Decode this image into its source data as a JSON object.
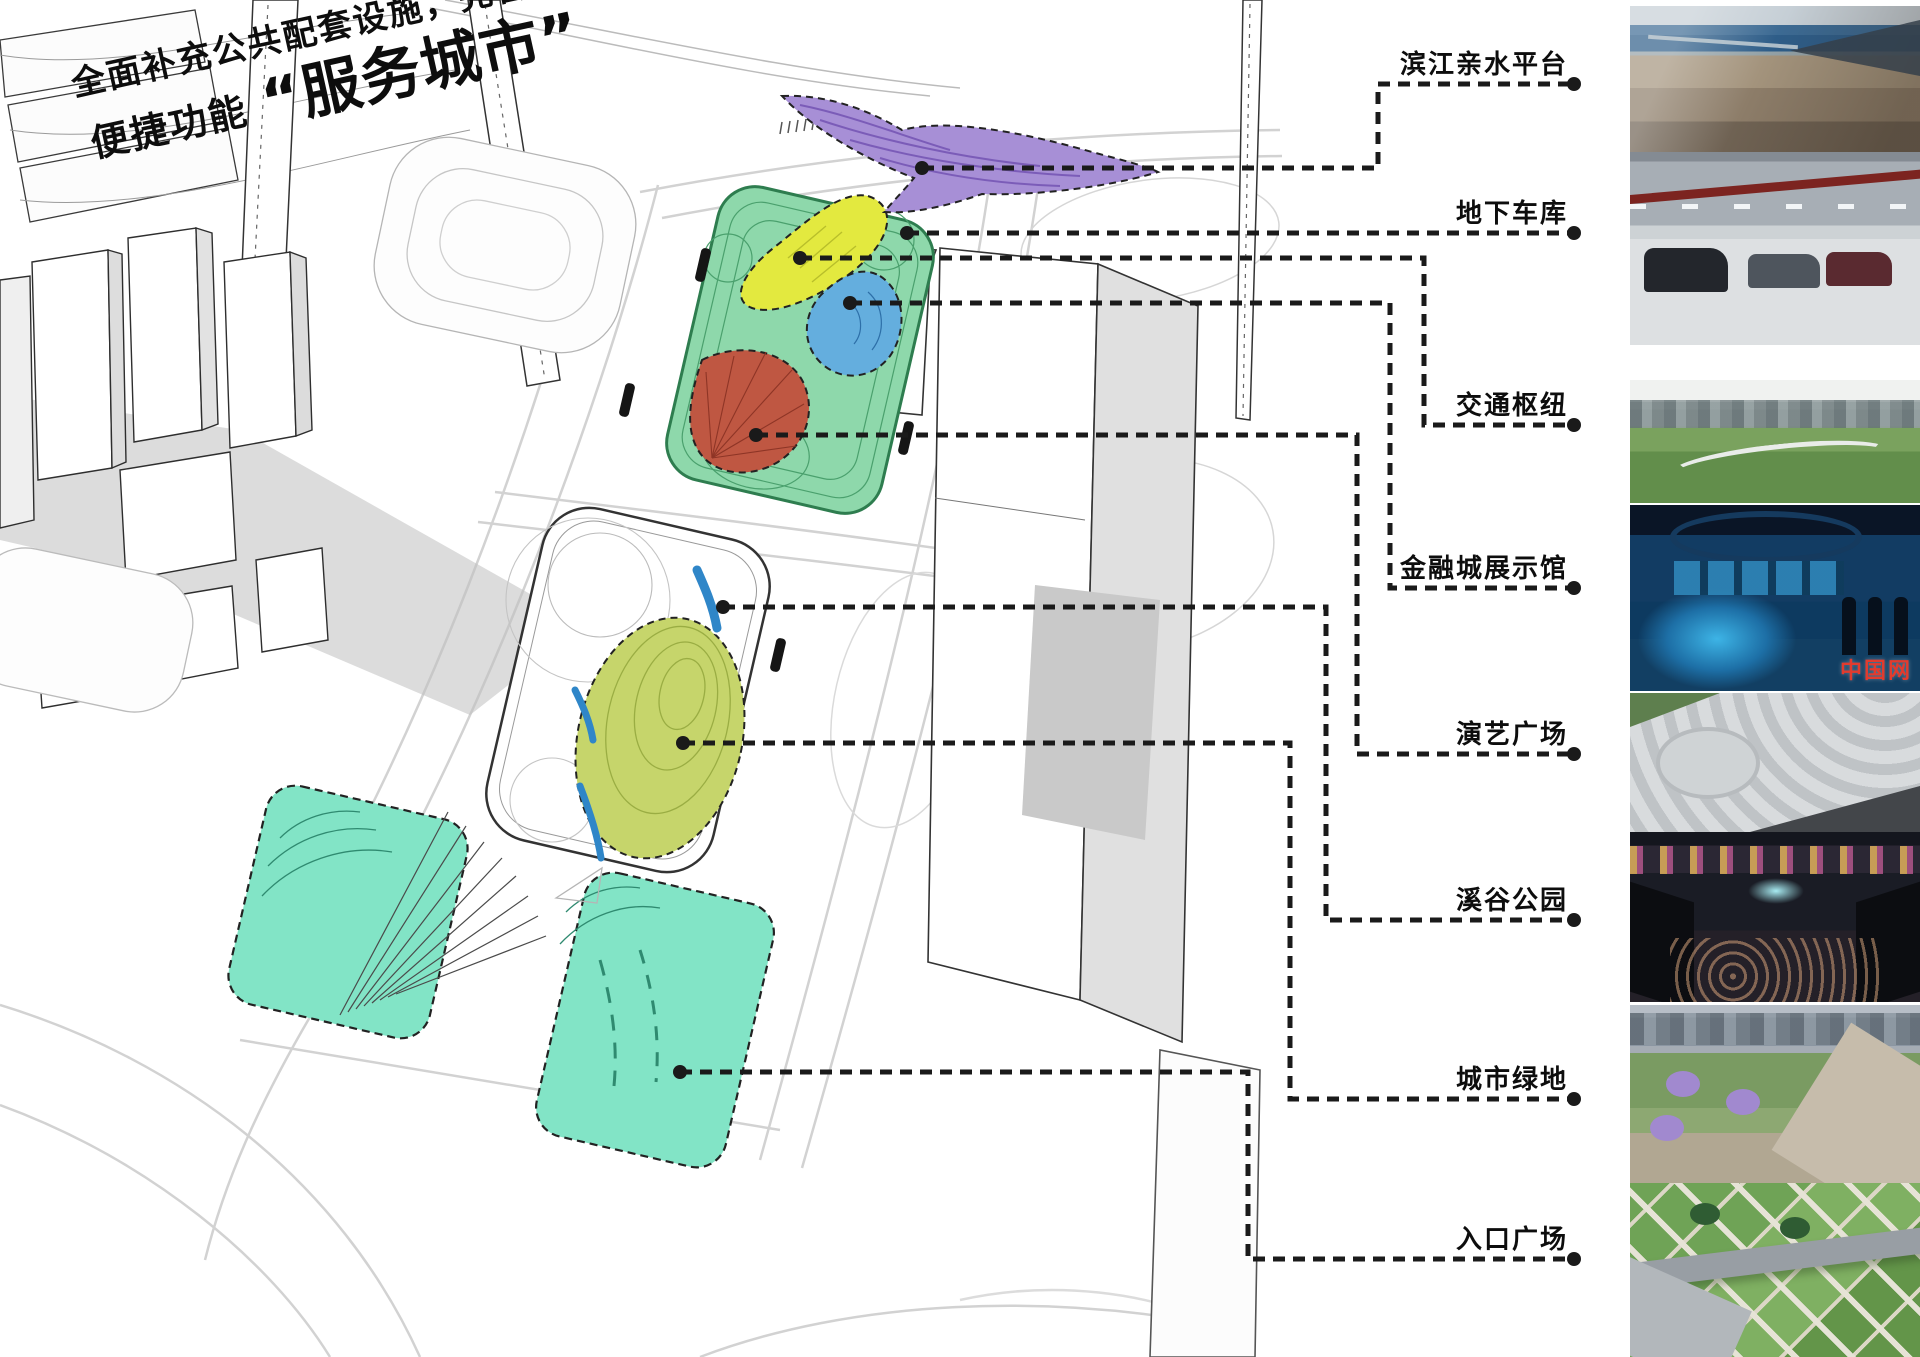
{
  "page": {
    "background": "#ffffff"
  },
  "title": {
    "line1": "全面补充公共配套设施，完善城市",
    "line2_prefix": "便捷功能",
    "line2_quote": "“服务城市”"
  },
  "labels": [
    {
      "id": "riverside-platform",
      "text": "滨江亲水平台",
      "points": [
        [
          922,
          168
        ],
        [
          1378,
          168
        ],
        [
          1378,
          84
        ],
        [
          1574,
          84
        ]
      ]
    },
    {
      "id": "underground-garage",
      "text": "地下车库",
      "points": [
        [
          907,
          233
        ],
        [
          1574,
          233
        ]
      ]
    },
    {
      "id": "transport-hub",
      "text": "交通枢纽",
      "points": [
        [
          800,
          258
        ],
        [
          1424,
          258
        ],
        [
          1424,
          425
        ],
        [
          1574,
          425
        ]
      ]
    },
    {
      "id": "finance-city-exhibition-hall",
      "text": "金融城展示馆",
      "points": [
        [
          850,
          303
        ],
        [
          1390,
          303
        ],
        [
          1390,
          588
        ],
        [
          1574,
          588
        ]
      ]
    },
    {
      "id": "performance-plaza",
      "text": "演艺广场",
      "points": [
        [
          756,
          435
        ],
        [
          1357,
          435
        ],
        [
          1357,
          754
        ],
        [
          1574,
          754
        ]
      ]
    },
    {
      "id": "valley-park",
      "text": "溪谷公园",
      "points": [
        [
          723,
          607
        ],
        [
          1326,
          607
        ],
        [
          1326,
          920
        ],
        [
          1574,
          920
        ]
      ]
    },
    {
      "id": "urban-green-space",
      "text": "城市绿地",
      "points": [
        [
          683,
          743
        ],
        [
          1290,
          743
        ],
        [
          1290,
          1099
        ],
        [
          1574,
          1099
        ]
      ]
    },
    {
      "id": "entrance-plaza",
      "text": "入口广场",
      "points": [
        [
          680,
          1072
        ],
        [
          1248,
          1072
        ],
        [
          1248,
          1259
        ],
        [
          1574,
          1259
        ]
      ]
    }
  ],
  "zones": [
    {
      "name": "滨江亲水平台",
      "color": "#a78fd6"
    },
    {
      "name": "交通枢纽",
      "color": "#e3e93f"
    },
    {
      "name": "金融城展示馆",
      "color": "#64aede"
    },
    {
      "name": "演艺广场",
      "color": "#bf5742"
    },
    {
      "name": "溪谷公园",
      "color": "#2f86c8"
    },
    {
      "name": "城市绿地",
      "color": "#c6d56b"
    },
    {
      "name": "入口广场",
      "color": "#82e4c6"
    },
    {
      "name": "公园地块",
      "color": "#8ed8ab"
    }
  ],
  "leader_style": {
    "color": "#1a1a1a",
    "dash": "12 8",
    "width": 5
  },
  "watermark": {
    "text": "中国网"
  },
  "photos": [
    {
      "id": "waterfront-deck-photo"
    },
    {
      "id": "underground-parking-photo"
    },
    {
      "id": "transport-hub-photo"
    },
    {
      "id": "exhibition-hall-photo"
    },
    {
      "id": "amphitheater-photo"
    },
    {
      "id": "stream-valley-photo"
    },
    {
      "id": "urban-greenery-photo"
    },
    {
      "id": "entrance-plaza-photo"
    }
  ]
}
